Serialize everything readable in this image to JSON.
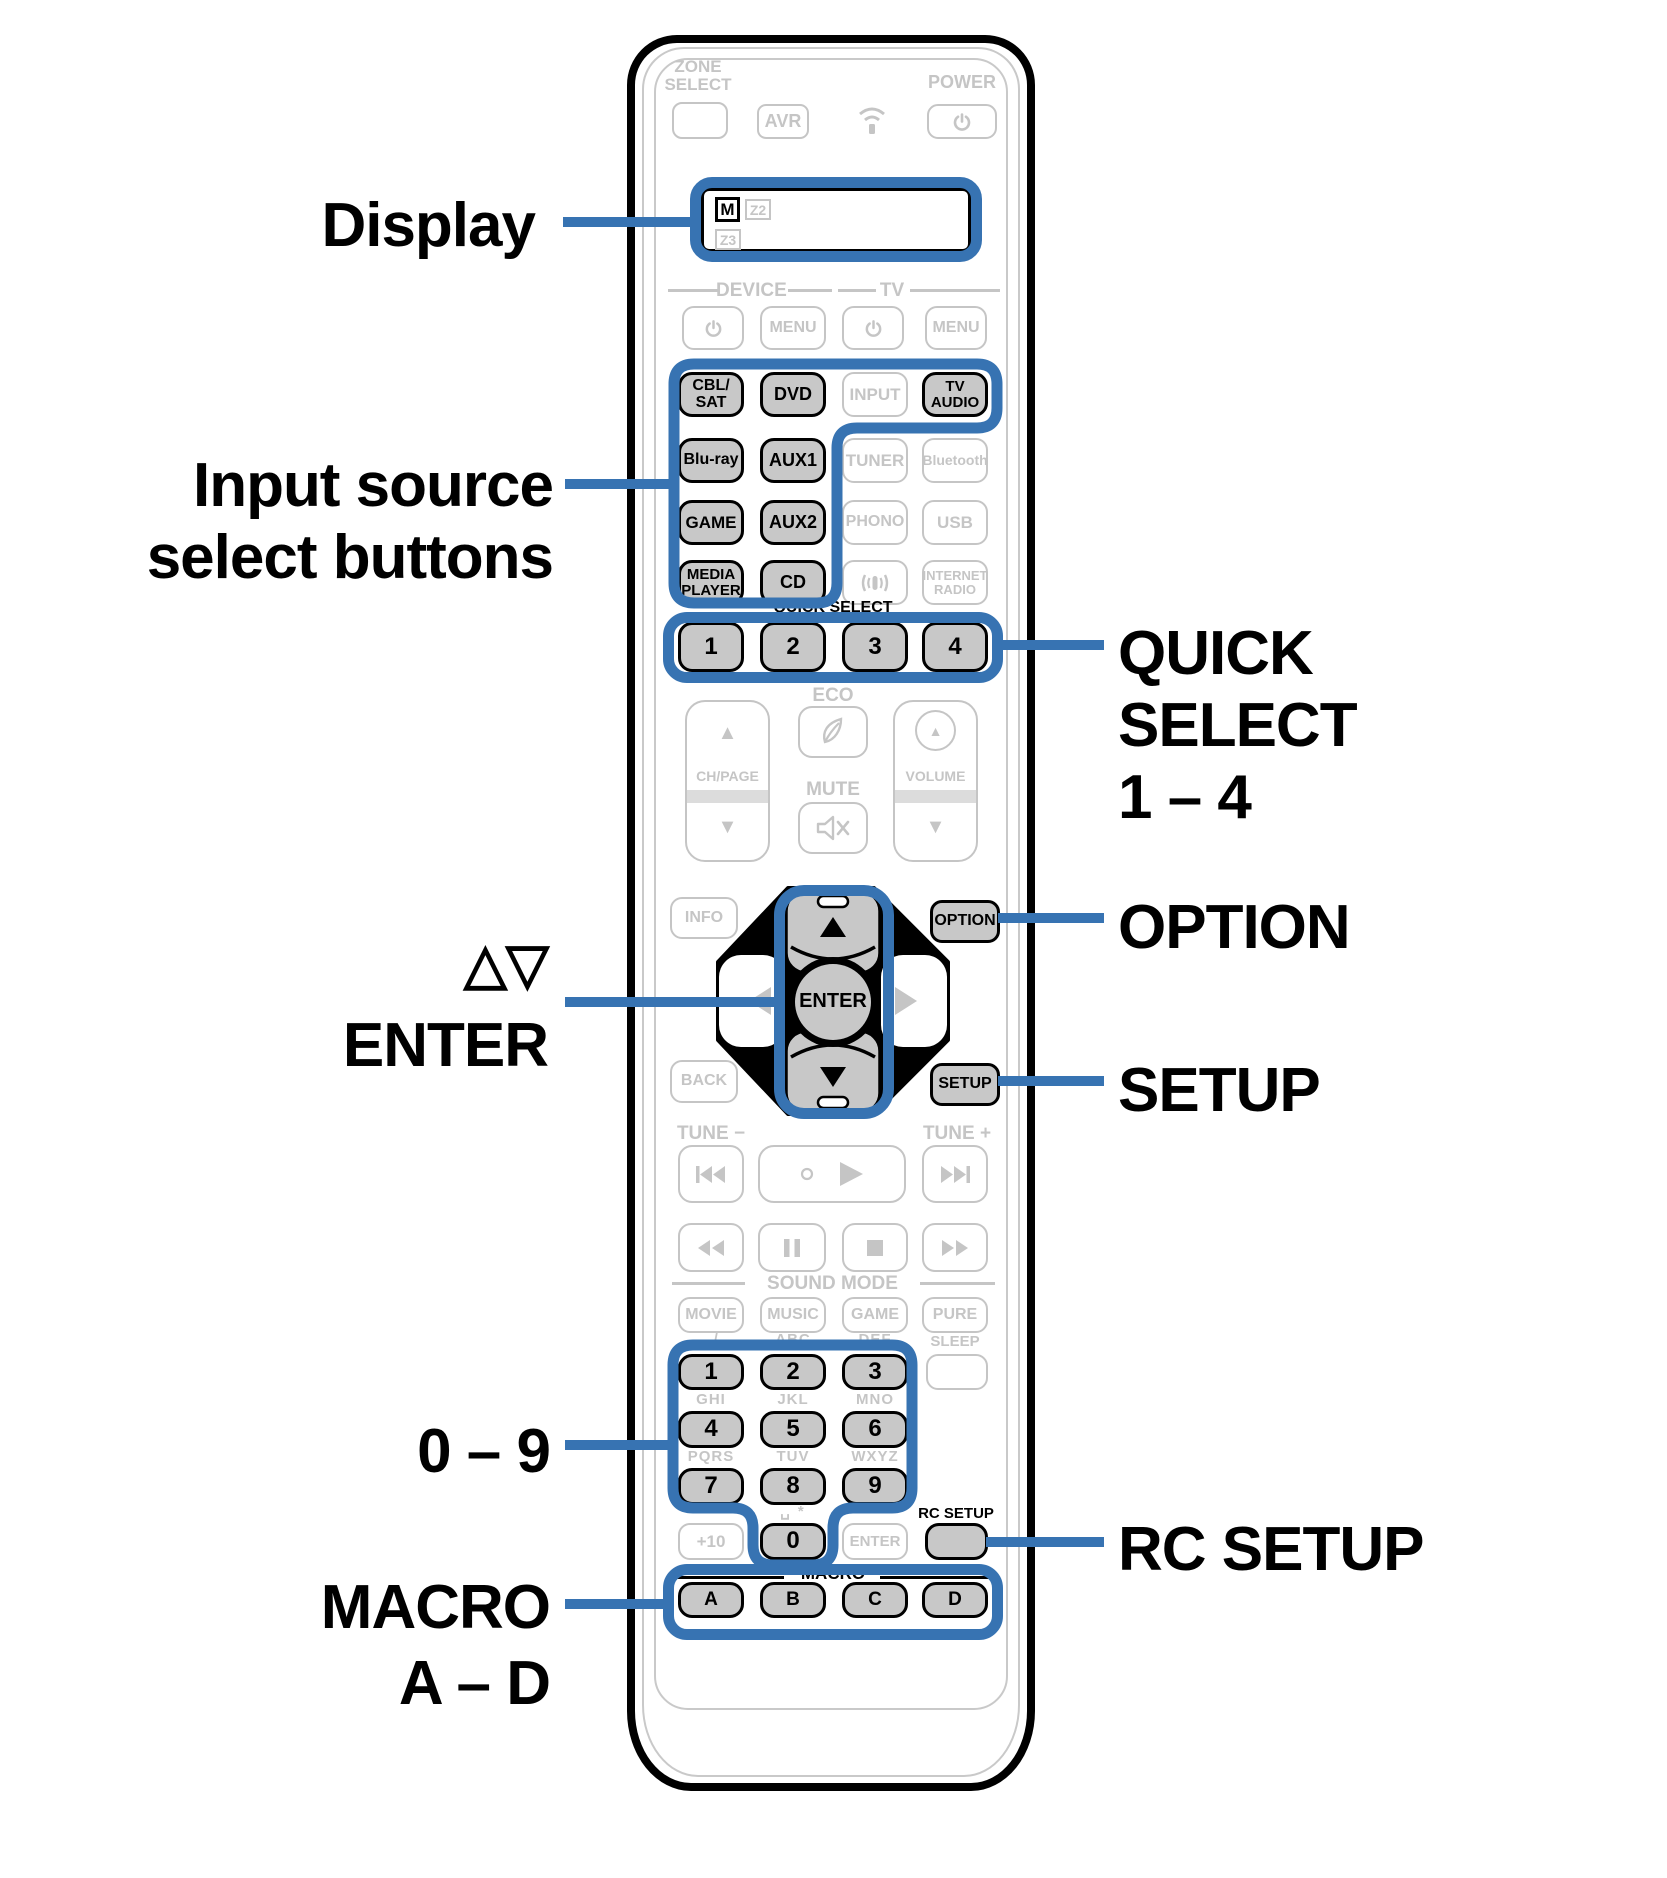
{
  "colors": {
    "accent": "#3773b2",
    "inactive": "#c5c5c5",
    "button_fill": "#c8c8c8"
  },
  "icons": {
    "up_triangle": "▲",
    "down_triangle": "▼"
  },
  "callouts": {
    "display": "Display",
    "input_source_1": "Input source",
    "input_source_2": "select buttons",
    "cursor_symbols": "△▽",
    "cursor_enter": "ENTER",
    "digits": "0 – 9",
    "macro": "MACRO",
    "macro_range": "A – D",
    "quick_1": "QUICK",
    "quick_2": "SELECT",
    "quick_3": "1 – 4",
    "option": "OPTION",
    "setup": "SETUP",
    "rc_setup": "RC SETUP"
  },
  "remote": {
    "zone_select_1": "ZONE",
    "zone_select_2": "SELECT",
    "avr": "AVR",
    "power_label": "POWER",
    "display": {
      "main_zone": "M",
      "zone2": "Z2",
      "zone3": "Z3"
    },
    "device_header": "DEVICE",
    "tv_header": "TV",
    "menu": "MENU",
    "inputs": {
      "cbl_1": "CBL/",
      "cbl_2": "SAT",
      "dvd": "DVD",
      "input": "INPUT",
      "tv_audio_1": "TV",
      "tv_audio_2": "AUDIO",
      "bluray": "Blu-ray",
      "aux1": "AUX1",
      "tuner": "TUNER",
      "bluetooth": "Bluetooth",
      "game": "GAME",
      "aux2": "AUX2",
      "phono": "PHONO",
      "usb": "USB",
      "media_1": "MEDIA",
      "media_2": "PLAYER",
      "cd": "CD",
      "internet_1": "INTERNET",
      "internet_2": "RADIO"
    },
    "quick_select_header": "QUICK SELECT",
    "quick": {
      "q1": "1",
      "q2": "2",
      "q3": "3",
      "q4": "4"
    },
    "eco": "ECO",
    "ch_page": "CH/PAGE",
    "mute": "MUTE",
    "volume": "VOLUME",
    "info": "INFO",
    "option": "OPTION",
    "back": "BACK",
    "setup": "SETUP",
    "enter": "ENTER",
    "tune_minus": "TUNE −",
    "tune_plus": "TUNE +",
    "sound_mode_header": "SOUND MODE",
    "sound": {
      "movie": "MOVIE",
      "music": "MUSIC",
      "game": "GAME",
      "pure": "PURE"
    },
    "keypad": {
      "l1": ". /",
      "l2": "ABC",
      "l3": "DEF",
      "sleep": "SLEEP",
      "k1": "1",
      "k2": "2",
      "k3": "3",
      "l4": "GHI",
      "l5": "JKL",
      "l6": "MNO",
      "k4": "4",
      "k5": "5",
      "k6": "6",
      "l7": "PQRS",
      "l8": "TUV",
      "l9": "WXYZ",
      "k7": "7",
      "k8": "8",
      "k9": "9",
      "space_star": "␣ *",
      "plus10": "+10",
      "k0": "0",
      "enter": "ENTER",
      "rc_setup": "RC SETUP"
    },
    "macro_header": "MACRO",
    "macro": {
      "a": "A",
      "b": "B",
      "c": "C",
      "d": "D"
    }
  }
}
